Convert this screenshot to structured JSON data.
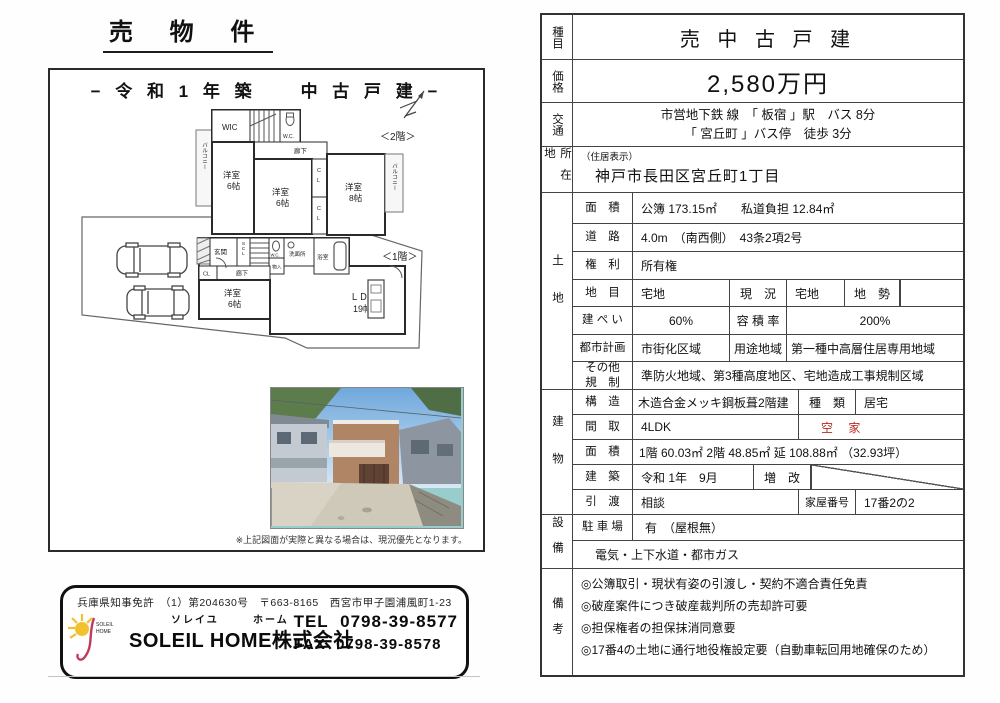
{
  "colors": {
    "vacant_red": "#b92a22",
    "logo_yellow": "#f2c22e",
    "logo_red": "#c23a5a"
  },
  "left": {
    "title": "売 物 件",
    "header": "− 令 和 1 年 築　　中 古 戸 建 −",
    "note": "※上記図面が実際と異なる場合は、現況優先となります。",
    "floor2": {
      "label": "＜2階＞",
      "balcony": "バルコニー",
      "wic": "WIC",
      "wc": "W.C.",
      "hall": "廊下",
      "cl_c": "C",
      "cl_l": "L",
      "room1": {
        "name": "洋室",
        "size": "6帖"
      },
      "room2": {
        "name": "洋室",
        "size": "6帖"
      },
      "room3": {
        "name": "洋室",
        "size": "8帖"
      }
    },
    "floor1": {
      "label": "＜1階＞",
      "genkan": "玄関",
      "scl": "SCL",
      "wc": "W.C.",
      "monoire": "物入",
      "senmen": "洗面所",
      "bath": "浴室",
      "cl": "CL",
      "hall": "廊下",
      "room": {
        "name": "洋室",
        "size": "6帖"
      },
      "ldk": {
        "name": "ＬＤＫ",
        "size": "19帖"
      }
    },
    "company": {
      "license": "兵庫県知事免許　（1）第204630号　〒663-8165　西宮市甲子園浦風町1-23",
      "furigana1": "ソレイユ",
      "furigana2": "ホーム",
      "name": "SOLEIL HOME株式会社",
      "tel_label": "TEL",
      "tel": "0798-39-8577",
      "fax_label": "FAX",
      "fax": "0798-39-8578",
      "logo_line1": "SOLEIL",
      "logo_line2": "HOME"
    }
  },
  "table": {
    "shumoku": {
      "label": "種目",
      "value": "売 中 古 戸 建"
    },
    "kakaku": {
      "label": "価格",
      "value": "2,580万円"
    },
    "kotsu": {
      "label": "交通",
      "line1": "市営地下鉄 線　「 板宿 」駅　バス 8分",
      "line2": "「 宮丘町 」バス停　徒歩 3分"
    },
    "shozaichi": {
      "label": "所在地",
      "note": "（住居表示）",
      "value": "神戸市長田区宮丘町1丁目"
    },
    "tochi": {
      "label": "土地",
      "menseki": {
        "label": "面　積",
        "value": "公簿 173.15㎡　　私道負担 12.84㎡"
      },
      "doro": {
        "label": "道　路",
        "value": "4.0m　（南西側）　43条2項2号"
      },
      "kenri": {
        "label": "権　利",
        "value": "所有権"
      },
      "chimoku": {
        "label": "地　目",
        "value": "宅地",
        "genkyo_label": "現　況",
        "genkyo": "宅地",
        "chisei_label": "地　勢",
        "chisei": ""
      },
      "kenpei": {
        "label": "建 ぺ い",
        "value": "60%",
        "yoseki_label": "容 積 率",
        "yoseki": "200%"
      },
      "toshi": {
        "label": "都市計画",
        "value": "市街化区域",
        "yoto_label": "用途地域",
        "yoto": "第一種中高層住居専用地域"
      },
      "sonota": {
        "label1": "その他",
        "label2": "規　制",
        "value": "準防火地域、第3種高度地区、宅地造成工事規制区域"
      }
    },
    "tatemono": {
      "label": "建物",
      "kozo": {
        "label": "構　造",
        "value": "木造合金メッキ鋼板葺2階建",
        "shurui_label": "種　類",
        "shurui": "居宅"
      },
      "madori": {
        "label": "間　取",
        "value": "4LDK",
        "akiya": "空 家"
      },
      "menseki": {
        "label": "面　積",
        "value": "1階 60.03㎡  2階 48.85㎡  延 108.88㎡ （32.93坪）"
      },
      "chiku": {
        "label": "建　築",
        "value": "令和 1年　9月",
        "zokai_label": "増　改"
      },
      "hikiwatashi": {
        "label": "引　渡",
        "value": "相談",
        "kaoku_label": "家屋番号",
        "kaoku": "17番2の2"
      }
    },
    "setsubi": {
      "label": "設備",
      "parking": {
        "label": "駐 車 場",
        "value": "有　（屋根無）"
      },
      "lifeline": "電気・上下水道・都市ガス"
    },
    "biko": {
      "label": "備考",
      "lines": [
        "◎公簿取引・現状有姿の引渡し・契約不適合責任免責",
        "◎破産案件につき破産裁判所の売却許可要",
        "◎担保権者の担保抹消同意要",
        "◎17番4の土地に通行地役権設定要（自動車転回用地確保のため）"
      ]
    }
  }
}
